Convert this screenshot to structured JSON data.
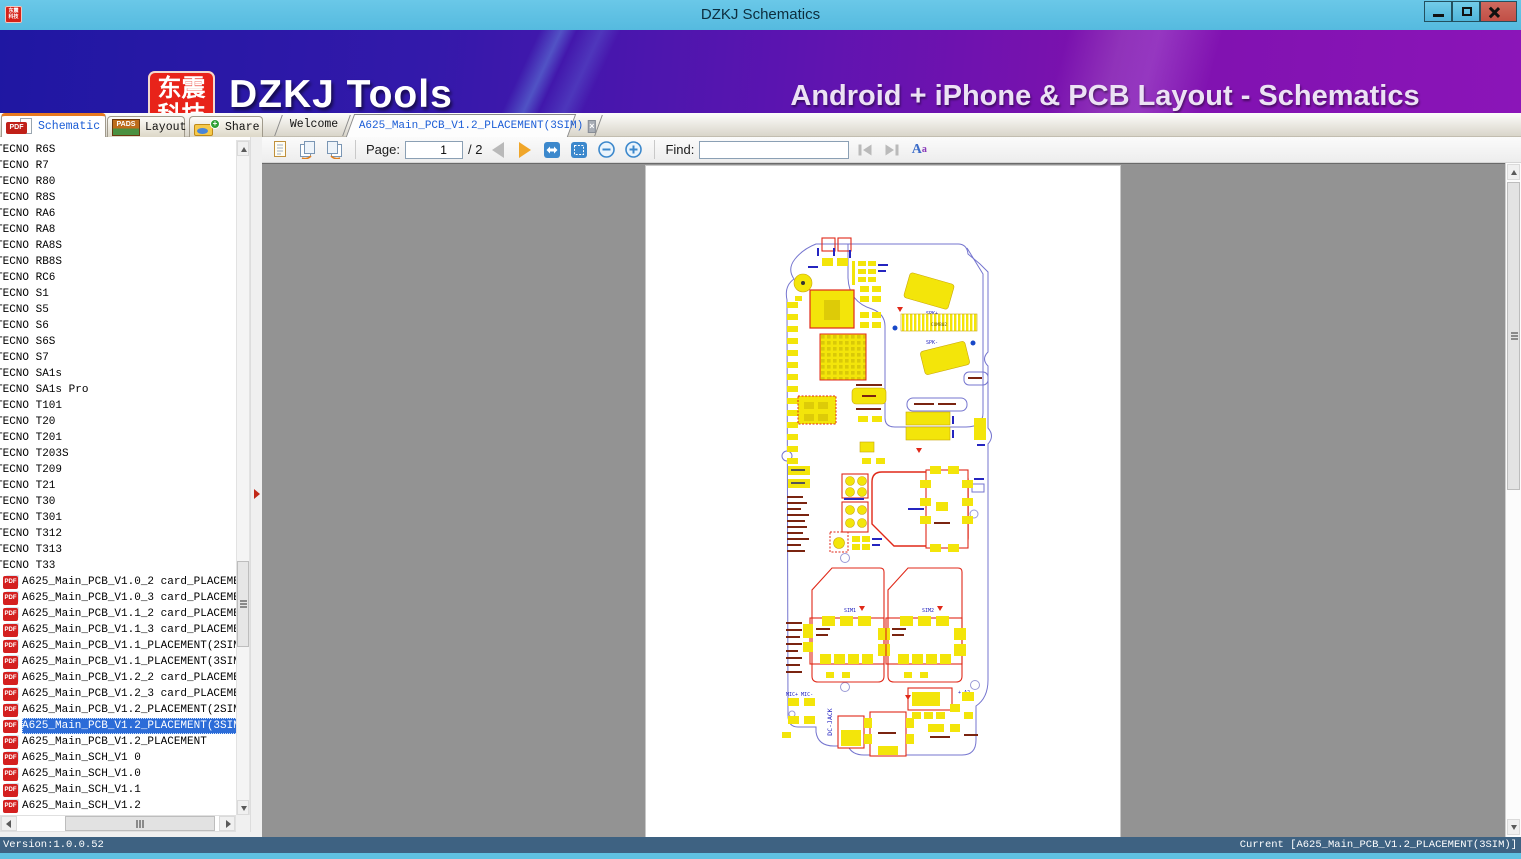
{
  "window": {
    "title": "DZKJ Schematics"
  },
  "banner": {
    "logo_top": "东震",
    "logo_bottom": "科技",
    "brand": "DZKJ Tools",
    "tagline": "Android + iPhone & PCB Layout - Schematics"
  },
  "tabs": {
    "main": [
      {
        "label": "Schematic"
      },
      {
        "label": "Layout"
      },
      {
        "label": "Share"
      }
    ],
    "docs": [
      {
        "label": "Welcome"
      },
      {
        "label": "A625_Main_PCB_V1.2_PLACEMENT(3SIM)"
      }
    ]
  },
  "icons": {
    "pdf_badge": "PDF",
    "pads_badge": "PADS",
    "share_plus": "+",
    "close_x": "×",
    "font_big": "A",
    "font_small": "a"
  },
  "toolbar": {
    "page_label": "Page:",
    "page_value": "1",
    "page_total": "/ 2",
    "find_label": "Find:",
    "find_value": ""
  },
  "sidebar": {
    "items": [
      {
        "type": "model",
        "label": "TECNO R6S"
      },
      {
        "type": "model",
        "label": "TECNO R7"
      },
      {
        "type": "model",
        "label": "TECNO R80"
      },
      {
        "type": "model",
        "label": "TECNO R8S"
      },
      {
        "type": "model",
        "label": "TECNO RA6"
      },
      {
        "type": "model",
        "label": "TECNO RA8"
      },
      {
        "type": "model",
        "label": "TECNO RA8S"
      },
      {
        "type": "model",
        "label": "TECNO RB8S"
      },
      {
        "type": "model",
        "label": "TECNO RC6"
      },
      {
        "type": "model",
        "label": "TECNO S1"
      },
      {
        "type": "model",
        "label": "TECNO S5"
      },
      {
        "type": "model",
        "label": "TECNO S6"
      },
      {
        "type": "model",
        "label": "TECNO S6S"
      },
      {
        "type": "model",
        "label": "TECNO S7"
      },
      {
        "type": "model",
        "label": "TECNO SA1s"
      },
      {
        "type": "model",
        "label": "TECNO SA1s Pro"
      },
      {
        "type": "model",
        "label": "TECNO T101"
      },
      {
        "type": "model",
        "label": "TECNO T20"
      },
      {
        "type": "model",
        "label": "TECNO T201"
      },
      {
        "type": "model",
        "label": "TECNO T203S"
      },
      {
        "type": "model",
        "label": "TECNO T209"
      },
      {
        "type": "model",
        "label": "TECNO T21"
      },
      {
        "type": "model",
        "label": "TECNO T30"
      },
      {
        "type": "model",
        "label": "TECNO T301"
      },
      {
        "type": "model",
        "label": "TECNO T312"
      },
      {
        "type": "model",
        "label": "TECNO T313"
      },
      {
        "type": "model",
        "label": "TECNO T33"
      },
      {
        "type": "pdf",
        "label": "A625_Main_PCB_V1.0_2 card_PLACEMENT"
      },
      {
        "type": "pdf",
        "label": "A625_Main_PCB_V1.0_3 card_PLACEMENT"
      },
      {
        "type": "pdf",
        "label": "A625_Main_PCB_V1.1_2 card_PLACEMENT"
      },
      {
        "type": "pdf",
        "label": "A625_Main_PCB_V1.1_3 card_PLACEMENT"
      },
      {
        "type": "pdf",
        "label": "A625_Main_PCB_V1.1_PLACEMENT(2SIM)"
      },
      {
        "type": "pdf",
        "label": "A625_Main_PCB_V1.1_PLACEMENT(3SIM)"
      },
      {
        "type": "pdf",
        "label": "A625_Main_PCB_V1.2_2 card_PLACEMENT"
      },
      {
        "type": "pdf",
        "label": "A625_Main_PCB_V1.2_3 card_PLACEMENT"
      },
      {
        "type": "pdf",
        "label": "A625_Main_PCB_V1.2_PLACEMENT(2SIM)"
      },
      {
        "type": "pdf",
        "label": "A625_Main_PCB_V1.2_PLACEMENT(3SIM)",
        "selected": true
      },
      {
        "type": "pdf",
        "label": "A625_Main_PCB_V1.2_PLACEMENT"
      },
      {
        "type": "pdf",
        "label": "A625_Main_SCH_V1 0"
      },
      {
        "type": "pdf",
        "label": "A625_Main_SCH_V1.0"
      },
      {
        "type": "pdf",
        "label": "A625_Main_SCH_V1.1"
      },
      {
        "type": "pdf",
        "label": "A625_Main_SCH_V1.2"
      }
    ]
  },
  "status": {
    "version": "Version:1.0.0.52",
    "current": "Current [A625_Main_PCB_V1.2_PLACEMENT(3SIM)]"
  },
  "pcb": {
    "comb02": "COMB02",
    "spk_plus": "SPK+",
    "spk_minus": "SPK-",
    "sim1": "SIM1",
    "sim2": "SIM2",
    "dc_jack": "DC-JACK",
    "a2": "+ A2",
    "mic": "MIC+ MIC-"
  }
}
